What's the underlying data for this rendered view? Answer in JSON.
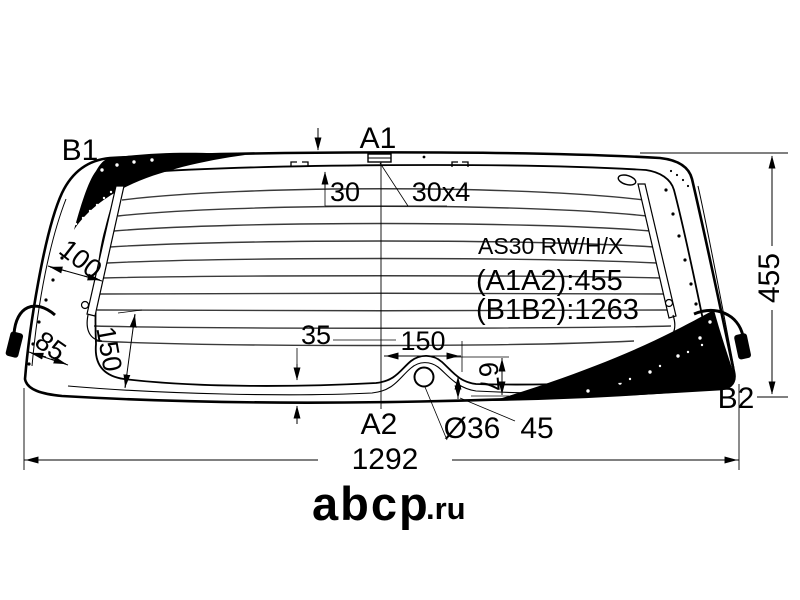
{
  "diagram": {
    "type": "rear-window-glass-technical-drawing",
    "part_code": "AS30 RW/H/X",
    "measurements": {
      "a1a2": "(A1A2):455",
      "b1b2": "(B1B2):1263"
    },
    "points": {
      "b1": "B1",
      "a1": "A1",
      "a2": "A2",
      "b2": "B2"
    },
    "dims": {
      "band_top": "30",
      "mount_plate": "30x4",
      "left_top": "100",
      "left_edge": "85",
      "left_height": "150",
      "bottom_band": "35",
      "bump_width": "150",
      "bump_height": "67",
      "hole_dia": "Ø36",
      "hole_offset": "45",
      "total_width": "1292",
      "total_height": "455"
    },
    "watermark": {
      "logo": "abcp",
      "tld": ".ru"
    },
    "colors": {
      "ink": "#000000",
      "paper": "#ffffff",
      "watermark": "#b4b6b9"
    }
  }
}
